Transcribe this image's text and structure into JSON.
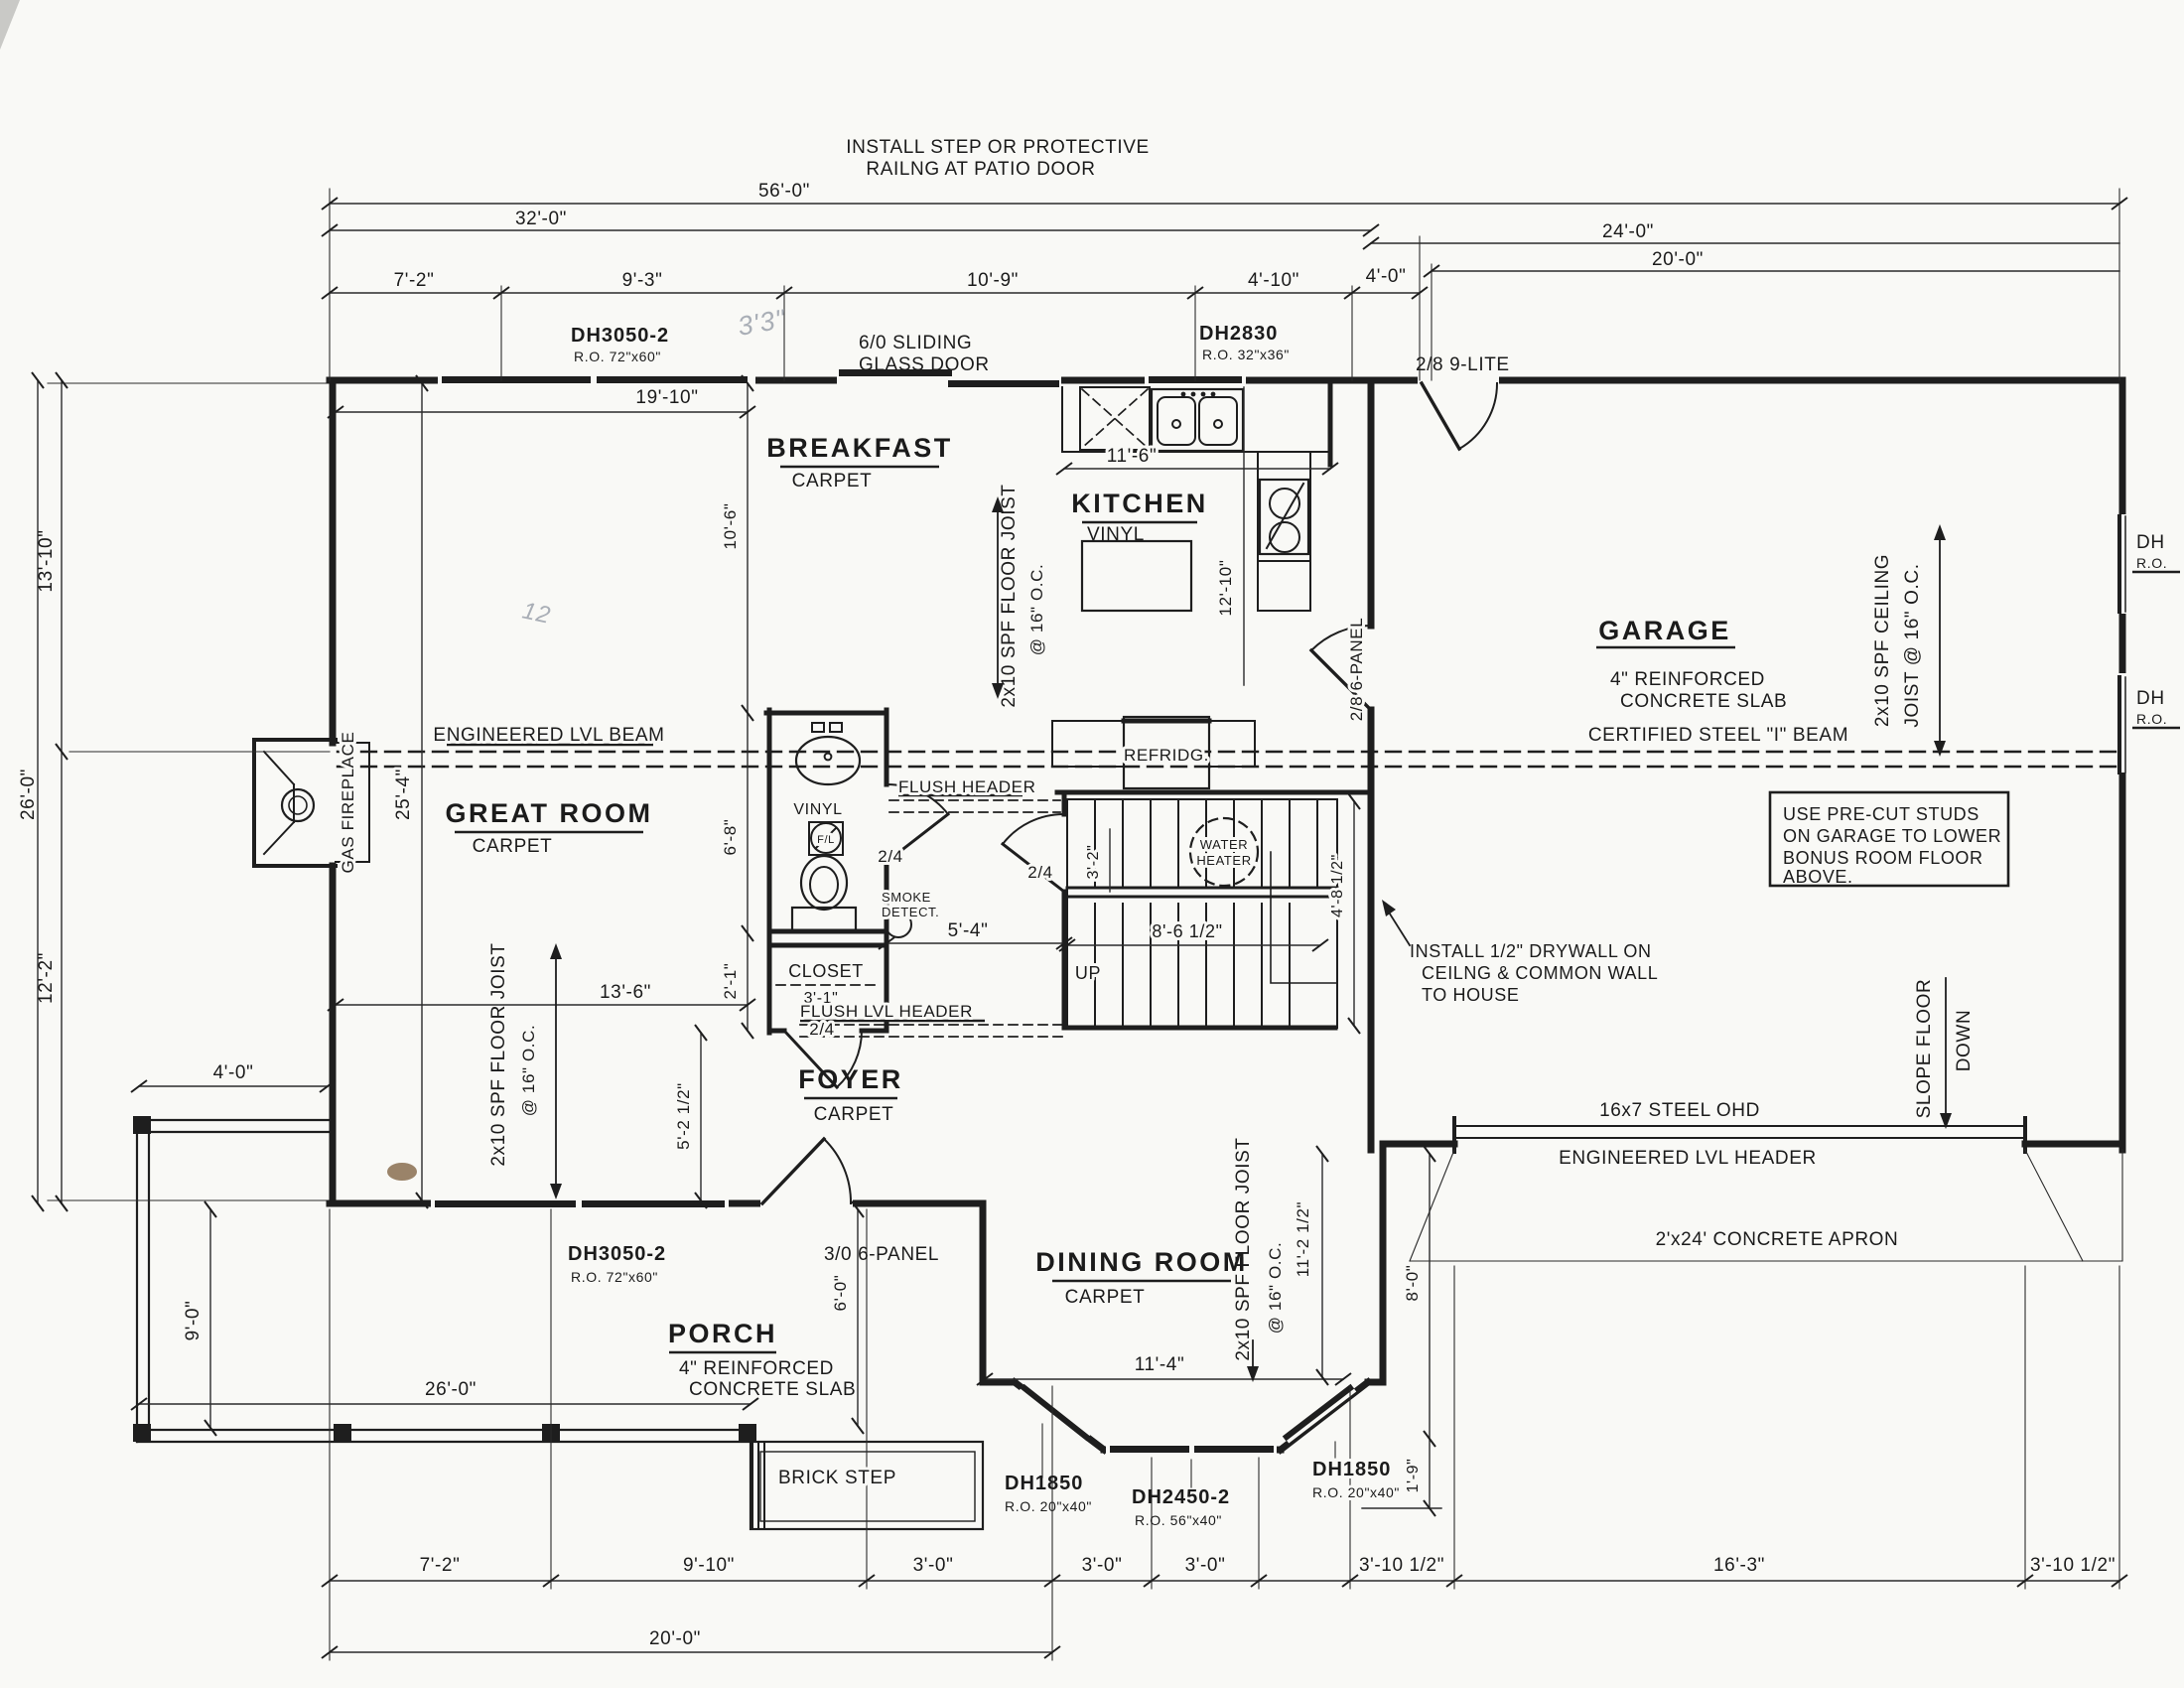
{
  "title_note": {
    "line1": "INSTALL STEP OR PROTECTIVE",
    "line2": "RAILNG AT PATIO DOOR"
  },
  "rooms": {
    "breakfast": {
      "name": "BREAKFAST",
      "floor": "CARPET"
    },
    "kitchen": {
      "name": "KITCHEN",
      "floor": "VINYL"
    },
    "garage": {
      "name": "GARAGE",
      "note1": "4\" REINFORCED",
      "note2": "CONCRETE SLAB"
    },
    "great_room": {
      "name": "GREAT ROOM",
      "floor": "CARPET"
    },
    "foyer": {
      "name": "FOYER",
      "floor": "CARPET"
    },
    "dining": {
      "name": "DINING ROOM",
      "floor": "CARPET"
    },
    "porch": {
      "name": "PORCH",
      "note1": "4\" REINFORCED",
      "note2": "CONCRETE SLAB"
    },
    "closet": {
      "name": "CLOSET"
    },
    "bath": {
      "floor": "VINYL"
    }
  },
  "windows": {
    "dh3050": "DH3050-2",
    "dh3050_ro": "R.O. 72\"x60\"",
    "dh2830": "DH2830",
    "dh2830_ro": "R.O. 32\"x36\"",
    "dh1850": "DH1850",
    "dh1850_ro": "R.O. 20\"x40\"",
    "dh2450": "DH2450-2",
    "dh2450_ro": "R.O. 56\"x40\"",
    "cut": "DH",
    "cut_ro": "R.O."
  },
  "doors": {
    "sliding1": "6/0 SLIDING",
    "sliding2": "GLASS DOOR",
    "nine_lite": "2/8 9-LITE",
    "six_panel": "2/8 6-PANEL",
    "front": "3/0 6-PANEL",
    "small": "2/4"
  },
  "beams": {
    "lvl": "ENGINEERED LVL BEAM",
    "steel": "CERTIFIED STEEL \"I\" BEAM",
    "flush": "FLUSH HEADER",
    "flush_lvl": "FLUSH LVL HEADER",
    "ohd": "16x7 STEEL OHD",
    "lvl_hdr": "ENGINEERED LVL HEADER",
    "apron": "2'x24' CONCRETE APRON"
  },
  "joists": {
    "floor": "2x10 SPF FLOOR JOIST",
    "oc": "@ 16\" O.C.",
    "ceiling1": "2x10 SPF CEILING",
    "ceiling2": "JOIST @ 16\" O.C."
  },
  "notes": {
    "drywall": [
      "INSTALL 1/2\" DRYWALL ON",
      "CEILNG & COMMON WALL",
      "TO HOUSE"
    ],
    "precut": [
      "USE PRE-CUT STUDS",
      "ON GARAGE TO LOWER",
      "BONUS ROOM FLOOR",
      "ABOVE."
    ],
    "slope1": "SLOPE FLOOR",
    "slope2": "DOWN"
  },
  "fixtures": {
    "dw": "DW",
    "fridge": "REFRIDG.",
    "wh1": "WATER",
    "wh2": "HEATER",
    "smoke1": "SMOKE",
    "smoke2": "DETECT.",
    "fireplace": "GAS FIREPLACE",
    "up": "UP",
    "fl": "F/L",
    "brick": "BRICK STEP"
  },
  "pencil": {
    "a": "3'3\"",
    "b": "12"
  },
  "dims": {
    "t56": "56'-0\"",
    "t32": "32'-0\"",
    "t24": "24'-0\"",
    "t20": "20'-0\"",
    "t7_2": "7'-2\"",
    "t9_3": "9'-3\"",
    "t10_9": "10'-9\"",
    "t4_10": "4'-10\"",
    "t4_0": "4'-0\"",
    "l13_10": "13'-10\"",
    "l26": "26'-0\"",
    "l12_2": "12'-2\"",
    "g19_10": "19'-10\"",
    "k11_6": "11'-6\"",
    "b10_6": "10'-6\"",
    "k12_10": "12'-10\"",
    "g25_4": "25'-4\"",
    "g13_6": "13'-6\"",
    "h5_4": "5'-4\"",
    "c3_1": "3'-1\"",
    "b6_8": "6'-8\"",
    "c2_1": "2'-1\"",
    "f5_2": "5'-2 1/2\"",
    "s3_2": "3'-2\"",
    "s8_6": "8'-6 1/2\"",
    "s4_8": "4'-8 1/2\"",
    "p4_0": "4'-0\"",
    "p9_0": "9'-0\"",
    "p26": "26'-0\"",
    "p6_0": "6'-0\"",
    "d11_4": "11'-4\"",
    "d11_2": "11'-2 1/2\"",
    "r8_0": "8'-0\"",
    "r1_9": "1'-9\"",
    "bt7_2": "7'-2\"",
    "bt9_10": "9'-10\"",
    "bt3_0": "3'-0\"",
    "bt3_10": "3'-10 1/2\"",
    "bt16_3": "16'-3\"",
    "bt20": "20'-0\""
  }
}
